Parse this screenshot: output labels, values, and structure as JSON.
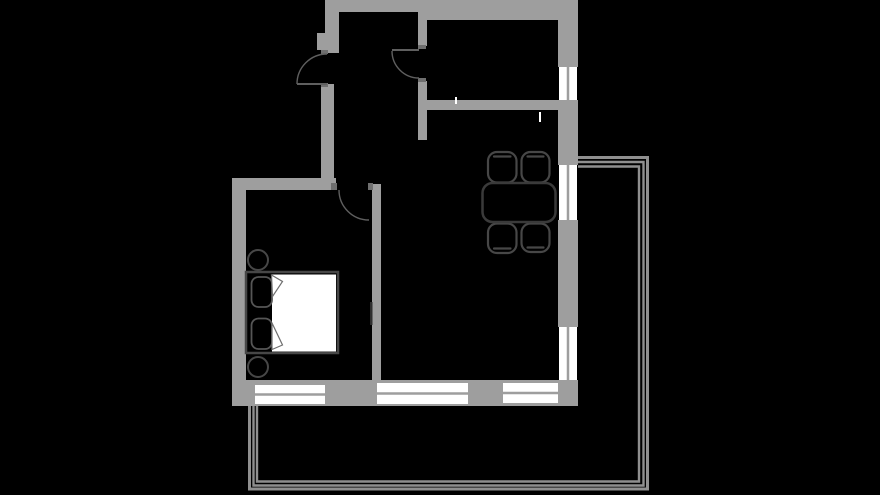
{
  "meta": {
    "description": "apartment floor plan, top-down view, dark theme",
    "canvas": {
      "width": 880,
      "height": 495,
      "background": "#000000"
    }
  },
  "palette": {
    "wall": "#9e9e9e",
    "jamb": "#6f6f6f",
    "window_glass": "#ffffff",
    "mullion": "#9e9e9e",
    "door_line": "#5f5f5f",
    "furniture_outline": "#474747",
    "furniture_outline_light": "#565656",
    "furniture_fill": "#000000",
    "mattress": "#ffffff",
    "fold_outline": "#6f6f6f",
    "balcony_rail": "#8f8f8f",
    "mark_white": "#ffffff",
    "mark_dark": "#2f2f2f"
  },
  "walls": [
    {
      "name": "entry-wall-upper",
      "x": 325,
      "y": 0,
      "w": 14,
      "h": 53
    },
    {
      "name": "entry-wall-pilaster",
      "x": 317,
      "y": 33,
      "w": 8,
      "h": 17
    },
    {
      "name": "hallway-west-wall",
      "x": 321,
      "y": 84,
      "w": 13,
      "h": 106
    },
    {
      "name": "top-wall-west",
      "x": 334,
      "y": 0,
      "w": 86,
      "h": 12
    },
    {
      "name": "kitchen-west-wall-upper",
      "x": 418,
      "y": 12,
      "w": 9,
      "h": 34
    },
    {
      "name": "top-wall-east",
      "x": 420,
      "y": 0,
      "w": 158,
      "h": 20
    },
    {
      "name": "kitchen-west-wall-lower",
      "x": 418,
      "y": 81,
      "w": 9,
      "h": 59
    },
    {
      "name": "kitchen-south-wall",
      "x": 427,
      "y": 100,
      "w": 131,
      "h": 10
    },
    {
      "name": "east-wall-segment-1",
      "x": 558,
      "y": 20,
      "w": 20,
      "h": 47
    },
    {
      "name": "east-wall-segment-2",
      "x": 558,
      "y": 100,
      "w": 20,
      "h": 65
    },
    {
      "name": "east-wall-segment-3",
      "x": 558,
      "y": 220,
      "w": 20,
      "h": 107
    },
    {
      "name": "east-wall-segment-4",
      "x": 558,
      "y": 380,
      "w": 20,
      "h": 26
    },
    {
      "name": "bedroom-north-wall",
      "x": 232,
      "y": 178,
      "w": 104,
      "h": 12
    },
    {
      "name": "bedroom-west-wall",
      "x": 232,
      "y": 178,
      "w": 14,
      "h": 228
    },
    {
      "name": "bedroom-living-divider-wall",
      "x": 372,
      "y": 184,
      "w": 9,
      "h": 196
    },
    {
      "name": "south-wall",
      "x": 232,
      "y": 380,
      "w": 346,
      "h": 26
    }
  ],
  "door_jambs": [
    {
      "name": "entry-door-jamb-top",
      "x": 321,
      "y": 50,
      "w": 7,
      "h": 4
    },
    {
      "name": "entry-door-jamb-bottom",
      "x": 321,
      "y": 83,
      "w": 7,
      "h": 4
    },
    {
      "name": "kitchen-door-jamb-top",
      "x": 418,
      "y": 45,
      "w": 8,
      "h": 4
    },
    {
      "name": "kitchen-door-jamb-bottom",
      "x": 418,
      "y": 78,
      "w": 8,
      "h": 4
    },
    {
      "name": "bedroom-door-jamb-left",
      "x": 331,
      "y": 183,
      "w": 6,
      "h": 7
    },
    {
      "name": "bedroom-door-jamb-right",
      "x": 368,
      "y": 183,
      "w": 5,
      "h": 7
    }
  ],
  "windows": [
    {
      "name": "kitchen-window-east",
      "x": 559,
      "y": 67,
      "w": 18,
      "h": 33,
      "mullion": "v"
    },
    {
      "name": "living-window-east-upper",
      "x": 559,
      "y": 165,
      "w": 18,
      "h": 55,
      "mullion": "v"
    },
    {
      "name": "living-window-east-lower",
      "x": 559,
      "y": 327,
      "w": 18,
      "h": 53,
      "mullion": "v"
    },
    {
      "name": "bedroom-window-south",
      "x": 255,
      "y": 385,
      "w": 70,
      "h": 19,
      "mullion": "h"
    },
    {
      "name": "living-window-south-left",
      "x": 377,
      "y": 383,
      "w": 91,
      "h": 21,
      "mullion": "h"
    },
    {
      "name": "living-window-south-right",
      "x": 503,
      "y": 383,
      "w": 55,
      "h": 20,
      "mullion": "h"
    }
  ],
  "doors": [
    {
      "name": "entry-door",
      "leaf": "M297,84 L327,84",
      "arc": "M327,54 A30,30 0 0 0 297,84"
    },
    {
      "name": "kitchen-door",
      "leaf": "M392,50 L419,50",
      "arc": "M392,51 A27,27 0 0 0 419,78"
    },
    {
      "name": "bedroom-door",
      "leaf": null,
      "arc": "M339,190 A30,30 0 0 0 369,220"
    }
  ],
  "furniture": {
    "bed_frame": {
      "name": "bed",
      "x": 246,
      "y": 272,
      "w": 92,
      "h": 81
    },
    "bed_mattress": {
      "name": "bed-mattress",
      "x": 272,
      "y": 274.5,
      "w": 64,
      "h": 77
    },
    "pillows": [
      {
        "name": "pillow-top",
        "x": 251.5,
        "y": 277,
        "w": 20.5,
        "h": 30
      },
      {
        "name": "pillow-bottom",
        "x": 251.5,
        "y": 318.5,
        "w": 20.5,
        "h": 30.5
      }
    ],
    "blanket_folds": [
      {
        "name": "blanket-fold-top",
        "d": "M271.5,275 L282.5,281.5 L272.5,296.5 Z"
      },
      {
        "name": "blanket-fold-bottom",
        "d": "M272,323 L282.5,345 L272,349.5 Z"
      }
    ],
    "nightstands": [
      {
        "name": "nightstand-top",
        "cx": 258,
        "cy": 260,
        "r": 10
      },
      {
        "name": "nightstand-bottom",
        "cx": 258,
        "cy": 367,
        "r": 10
      }
    ],
    "dining_table": {
      "name": "dining-table",
      "x": 482.5,
      "y": 183,
      "w": 73,
      "h": 39,
      "rx": 10
    },
    "chairs": [
      {
        "name": "chair-top-left",
        "x": 488,
        "y": 152,
        "w": 28.5,
        "h": 30.5,
        "back": "top"
      },
      {
        "name": "chair-top-right",
        "x": 521.5,
        "y": 152,
        "w": 28,
        "h": 30.5,
        "back": "top"
      },
      {
        "name": "chair-bottom-left",
        "x": 488,
        "y": 223.5,
        "w": 28.5,
        "h": 29.5,
        "back": "bottom"
      },
      {
        "name": "chair-bottom-right",
        "x": 521.5,
        "y": 223.5,
        "w": 28,
        "h": 28.5,
        "back": "bottom"
      }
    ]
  },
  "balcony": {
    "rails": [
      {
        "name": "balcony-rail-outer",
        "d": "M578,157.5 H647.5 V489 H249.5 V406",
        "width": 3
      },
      {
        "name": "balcony-rail-middle",
        "d": "M578,162 H643.5 V485.5 H253.5 V406",
        "width": 2.4
      },
      {
        "name": "balcony-rail-inner",
        "d": "M578,166.5 H639 V481.5 H257 V406",
        "width": 2.4
      }
    ]
  },
  "marks": [
    {
      "name": "kitchen-fixture-mark",
      "x": 455,
      "y": 97,
      "w": 2,
      "h": 7,
      "tone": "white"
    },
    {
      "name": "dining-fixture-mark",
      "x": 539,
      "y": 112,
      "w": 2,
      "h": 10,
      "tone": "white"
    },
    {
      "name": "divider-wall-mark",
      "x": 370,
      "y": 302,
      "w": 2.5,
      "h": 23,
      "tone": "dark"
    }
  ]
}
